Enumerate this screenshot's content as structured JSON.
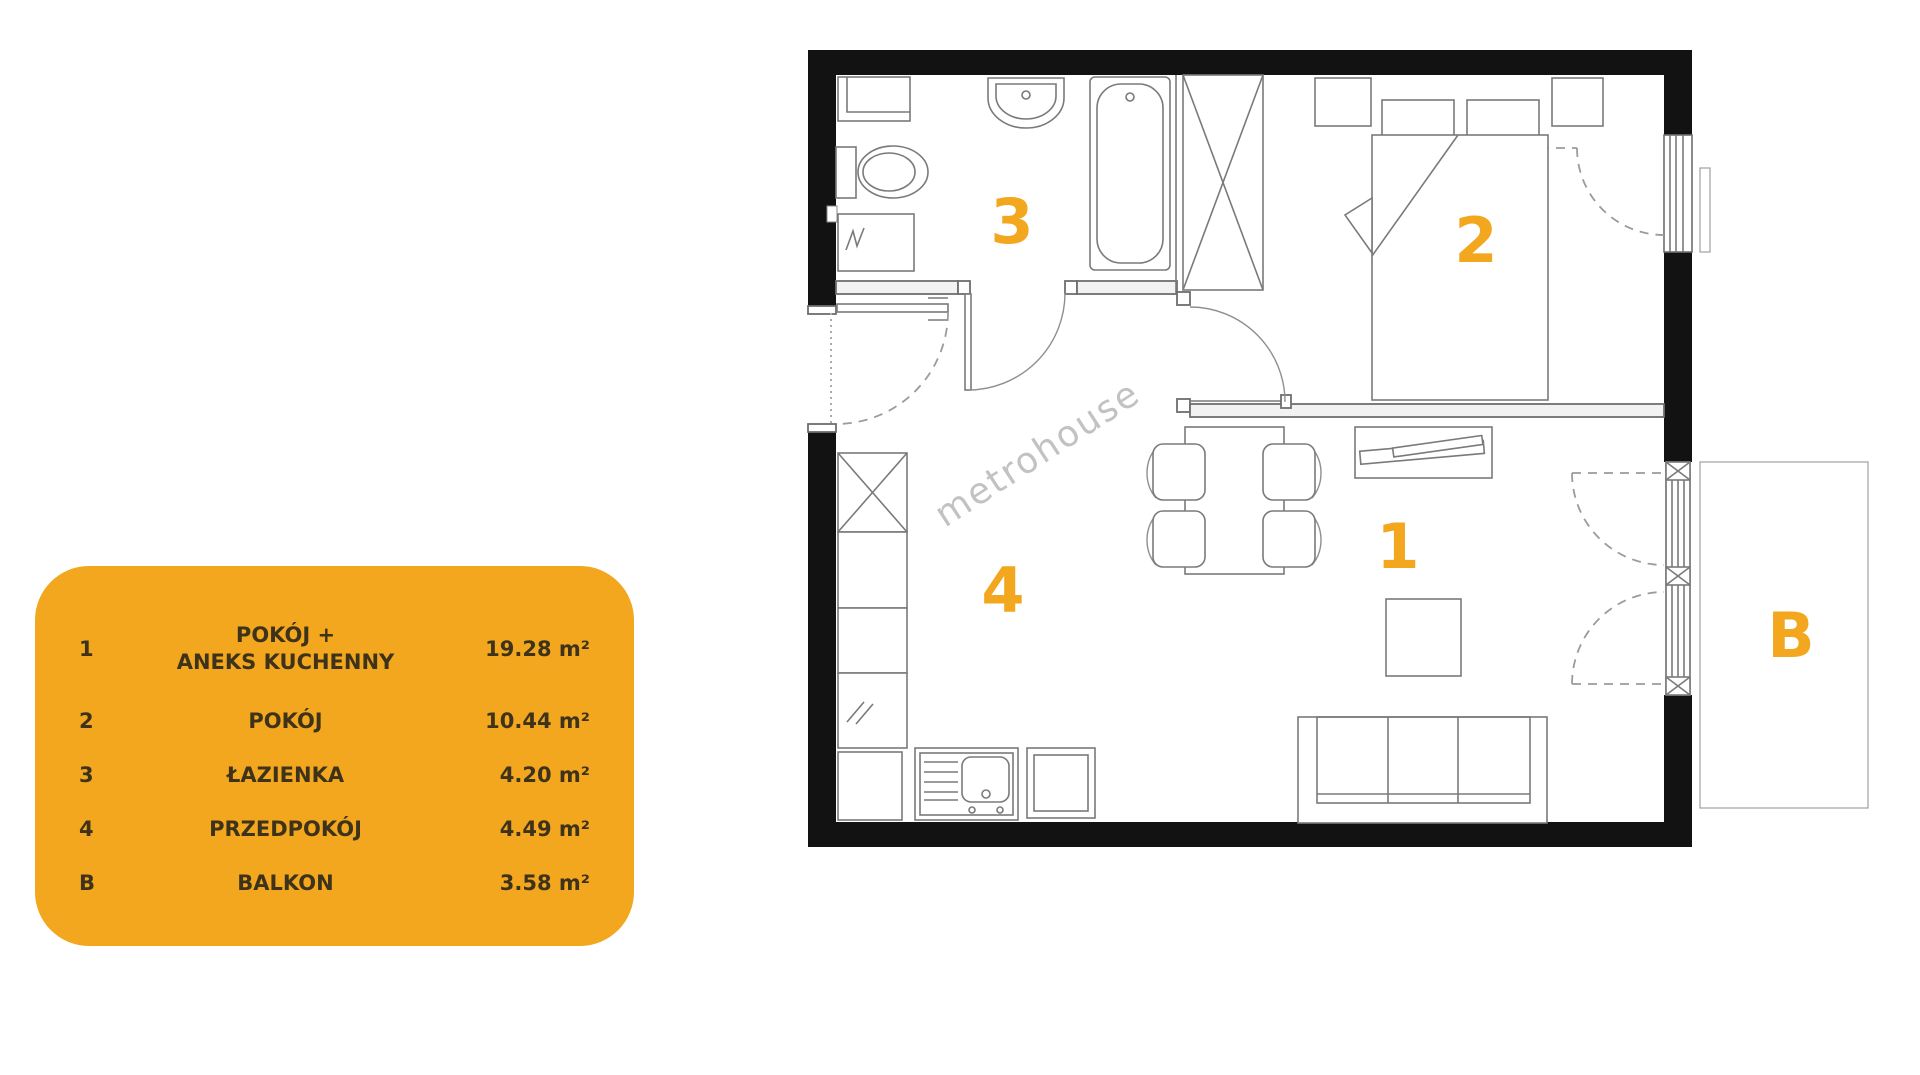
{
  "colors": {
    "accent": "#F2A71E",
    "legend_text": "#3E331A",
    "wall": "#121212",
    "line": "#777777",
    "watermark": "#C2C2C2"
  },
  "legend": {
    "rows": [
      {
        "id": "1",
        "name": "POKÓJ +",
        "name2": "ANEKS KUCHENNY",
        "area": "19.28 m²"
      },
      {
        "id": "2",
        "name": "POKÓJ",
        "name2": "",
        "area": "10.44 m²"
      },
      {
        "id": "3",
        "name": "ŁAZIENKA",
        "name2": "",
        "area": "4.20 m²"
      },
      {
        "id": "4",
        "name": "PRZEDPOKÓJ",
        "name2": "",
        "area": "4.49 m²"
      },
      {
        "id": "B",
        "name": "BALKON",
        "name2": "",
        "area": "3.58 m²"
      }
    ]
  },
  "plan": {
    "watermark": "metrohouse"
  }
}
